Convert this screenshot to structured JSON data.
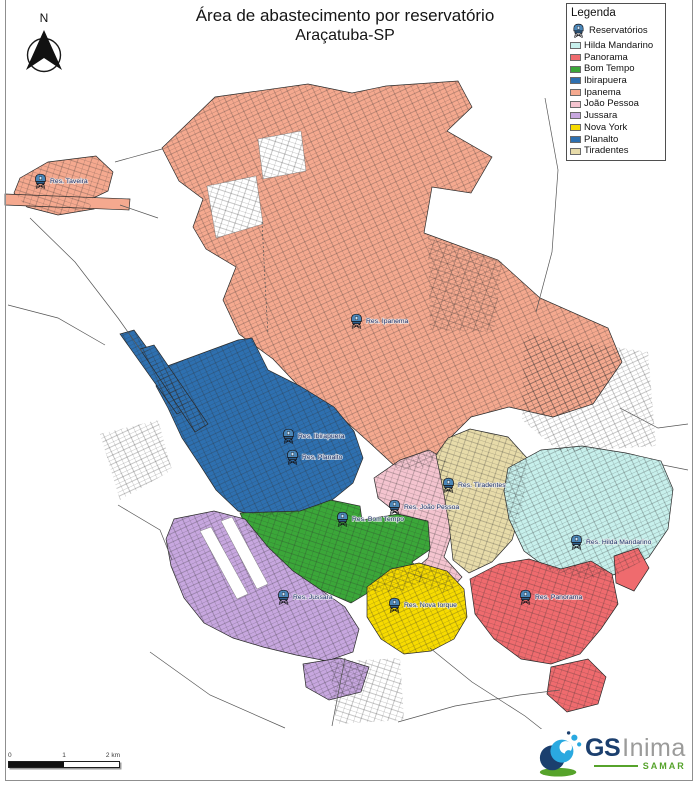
{
  "title": {
    "line1": "Área de abastecimento por reservatório",
    "line2": "Araçatuba-SP"
  },
  "north_label": "N",
  "legend": {
    "title": "Legenda",
    "reservoirs_label": "Reservatórios",
    "items": [
      {
        "key": "hilda_mandarino",
        "label": "Hilda Mandarino",
        "color": "#C7F0EC"
      },
      {
        "key": "panorama",
        "label": "Panorama",
        "color": "#EF6B6E"
      },
      {
        "key": "bom_tempo",
        "label": "Bom Tempo",
        "color": "#3BA739"
      },
      {
        "key": "ibirapuera",
        "label": "Ibirapuera",
        "color": "#2E70B0"
      },
      {
        "key": "ipanema",
        "label": "Ipanema",
        "color": "#F5A98F"
      },
      {
        "key": "joao_pessoa",
        "label": "João Pessoa",
        "color": "#F4C4CF"
      },
      {
        "key": "jussara",
        "label": "Jussara",
        "color": "#C7A7DF"
      },
      {
        "key": "nova_york",
        "label": "Nova York",
        "color": "#F7DB00"
      },
      {
        "key": "planalto",
        "label": "Planalto",
        "color": "#2E70B0"
      },
      {
        "key": "tiradentes",
        "label": "Tiradentes",
        "color": "#E7DBA9"
      }
    ]
  },
  "map_labels": [
    {
      "label": "Res. Taveira",
      "x": 50,
      "y": 183
    },
    {
      "label": "Res. Ipanema",
      "x": 366,
      "y": 323
    },
    {
      "label": "Res. Ibirapuera",
      "x": 298,
      "y": 438
    },
    {
      "label": "Res. Planalto",
      "x": 302,
      "y": 459
    },
    {
      "label": "Res. Tiradentes",
      "x": 458,
      "y": 487
    },
    {
      "label": "Res. João Pessoa",
      "x": 404,
      "y": 509
    },
    {
      "label": "Res. Bom Tempo",
      "x": 352,
      "y": 521
    },
    {
      "label": "Res. Hilda Mandarino",
      "x": 586,
      "y": 544
    },
    {
      "label": "Res. Jussara",
      "x": 293,
      "y": 599
    },
    {
      "label": "Res. Nova Iorque",
      "x": 404,
      "y": 607
    },
    {
      "label": "Res. Panorama",
      "x": 535,
      "y": 599
    }
  ],
  "scale_bar": {
    "tick_start": "0",
    "tick_mid": "1",
    "tick_end": "2 km"
  },
  "logo": {
    "gs": "GS",
    "inima": "Inima",
    "samar": "SAMAR",
    "colors": {
      "navy": "#1B3F6E",
      "gray": "#9B9B9A",
      "green": "#56A32B",
      "teal": "#2AA9E0"
    }
  }
}
